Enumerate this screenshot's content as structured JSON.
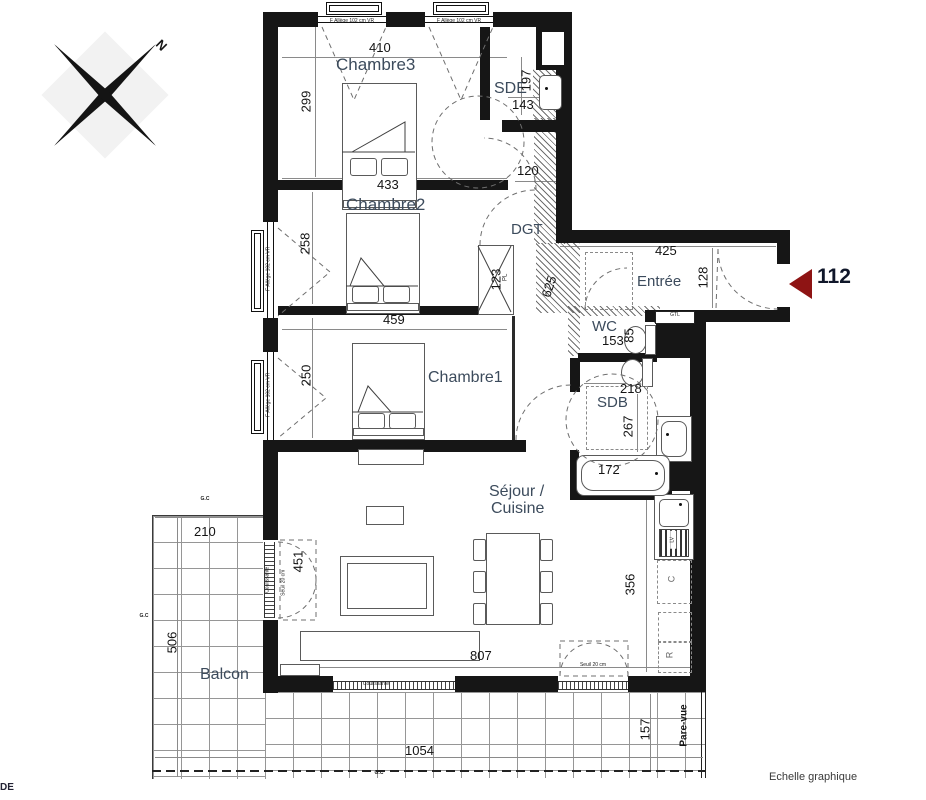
{
  "compass": {
    "north": "N"
  },
  "unit": {
    "number": "112",
    "arrow_color": "#8e1414"
  },
  "rooms": {
    "chambre3": "Chambre3",
    "chambre2": "Chambre2",
    "chambre1": "Chambre1",
    "sde": "SDE",
    "dgt": "DGT",
    "entree": "Entrée",
    "wc": "WC",
    "sdb": "SDB",
    "sejour_line1": "Séjour /",
    "sejour_line2": "Cuisine",
    "balcon": "Balcon"
  },
  "dims": {
    "ch3_top": "410",
    "ch3_left": "299",
    "ch3_bottom": "433",
    "sde_side": "197",
    "sde_width": "143",
    "dgt_width": "120",
    "ch2_left": "258",
    "ch2_bottom": "459",
    "closet": "123",
    "hall": "625",
    "entree_top": "425",
    "entree_side": "128",
    "wc_width": "153",
    "wc_side": "85",
    "sdb_top": "218",
    "sdb_side": "267",
    "bath": "172",
    "ch1_left": "250",
    "slider": "451",
    "balcon_top": "210",
    "balcon_side": "506",
    "kitchen_side": "356",
    "sejour_bottom": "807",
    "balcon_bottom": "1054",
    "balcon_right": "157"
  },
  "annotations": {
    "gtl": "GTL",
    "closet": "PL",
    "cooker": "C",
    "fridge": "R",
    "dishwasher": "LV",
    "pare_vue": "Pare-vue",
    "gc": "G.C",
    "window_full": "F   Allège 102 cm   VR",
    "sliding": "Coulissante",
    "seuil": "Seuil 20 cm",
    "scale_label": "Echelle graphique",
    "corner_label": "DE"
  }
}
